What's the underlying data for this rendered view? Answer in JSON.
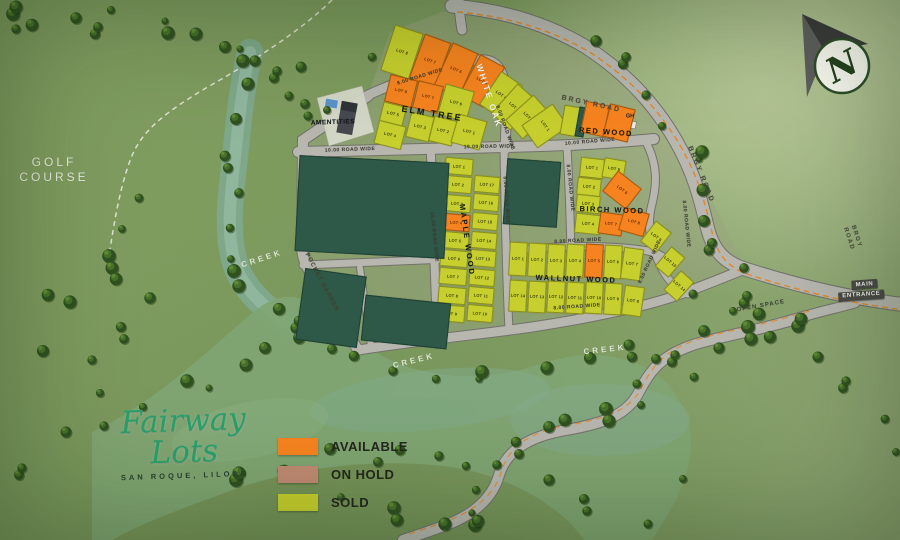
{
  "meta": {
    "title": "Fairway Lots - San Roque, Liloan - Site Development Map"
  },
  "logo": {
    "name": "Fairway Lots",
    "subtitle": "SAN ROQUE, LILOAN",
    "color": "#2aa06b"
  },
  "legend": {
    "items": [
      {
        "label": "AVAILABLE",
        "status": "available",
        "color": "#f6831f"
      },
      {
        "label": "ON HOLD",
        "status": "on_hold",
        "color": "#c08a72"
      },
      {
        "label": "SOLD",
        "status": "sold",
        "color": "#c6cf2d"
      }
    ]
  },
  "compass": {
    "letter": "N"
  },
  "entrance": {
    "line1": "MAIN",
    "line2": "ENTRANCE"
  },
  "blocks": [
    "WHITE OAK",
    "ELM TREE",
    "RED WOOD",
    "BIRCH WOOD",
    "MAPLE WOOD",
    "WALLNUT WOOD"
  ],
  "map": {
    "status_colors": {
      "available": "#f6831f",
      "on_hold": "#c08a72",
      "sold": "#c6cf2d",
      "open": "#2e5847"
    },
    "road_color": "#b7b7b0",
    "labels": [
      {
        "id": "golf-course-label",
        "text": "GOLF\nCOURSE",
        "x": 54,
        "y": 170,
        "rot": 0,
        "size": 12,
        "color": "#e9ece0",
        "ls": 3,
        "weight": 500
      },
      {
        "id": "creek-label-1",
        "text": "CREEK",
        "x": 262,
        "y": 259,
        "rot": -18,
        "size": 8,
        "color": "#dde4d2",
        "ls": 3,
        "weight": 600
      },
      {
        "id": "creek-label-2",
        "text": "CREEK",
        "x": 414,
        "y": 361,
        "rot": -14,
        "size": 8,
        "color": "#dde4d2",
        "ls": 3,
        "weight": 600
      },
      {
        "id": "creek-label-3",
        "text": "CREEK",
        "x": 605,
        "y": 350,
        "rot": -6,
        "size": 8,
        "color": "#dde4d2",
        "ls": 3,
        "weight": 600
      },
      {
        "id": "pocket-garden-label",
        "text": "POCKET GARDEN",
        "x": 321,
        "y": 283,
        "rot": 62,
        "size": 6,
        "color": "#40442f",
        "ls": 1,
        "weight": 600
      },
      {
        "id": "open-space-label",
        "text": "OPEN SPACE",
        "x": 761,
        "y": 307,
        "rot": -10,
        "size": 6,
        "color": "#3f4433",
        "ls": 1,
        "weight": 600
      },
      {
        "id": "brgy-road-label-1",
        "text": "BRGY ROAD",
        "x": 591,
        "y": 105,
        "rot": 12,
        "size": 7,
        "color": "#4a4a42",
        "ls": 2,
        "weight": 700
      },
      {
        "id": "brgy-road-label-2",
        "text": "BRGY ROAD",
        "x": 700,
        "y": 175,
        "rot": 68,
        "size": 7,
        "color": "#4a4a42",
        "ls": 2,
        "weight": 700
      },
      {
        "id": "brgy-road-label-3",
        "text": "BRGY ROAD",
        "x": 852,
        "y": 238,
        "rot": 72,
        "size": 6,
        "color": "#4a4a42",
        "ls": 1.5,
        "weight": 700
      },
      {
        "id": "road-width-label-1",
        "text": "8.00 ROAD WIDE",
        "x": 420,
        "y": 77,
        "rot": -17,
        "size": 5,
        "color": "#3c3c34",
        "ls": 0.5,
        "weight": 600
      },
      {
        "id": "road-width-label-2",
        "text": "8.00 ROAD WIDE",
        "x": 505,
        "y": 128,
        "rot": 70,
        "size": 5,
        "color": "#3c3c34",
        "ls": 0.5,
        "weight": 600
      },
      {
        "id": "road-width-label-3",
        "text": "10.00 ROAD WIDE",
        "x": 350,
        "y": 150,
        "rot": -2,
        "size": 5,
        "color": "#3c3c34",
        "ls": 0.5,
        "weight": 600
      },
      {
        "id": "road-width-label-4",
        "text": "19.00 ROAD WIDE",
        "x": 489,
        "y": 147,
        "rot": -1,
        "size": 5,
        "color": "#3c3c34",
        "ls": 0.5,
        "weight": 600
      },
      {
        "id": "road-width-label-5",
        "text": "10.00 ROAD WIDE",
        "x": 590,
        "y": 142,
        "rot": -5,
        "size": 5,
        "color": "#3c3c34",
        "ls": 0.5,
        "weight": 600
      },
      {
        "id": "road-width-label-6",
        "text": "16.00 ROAD WIDE",
        "x": 434,
        "y": 237,
        "rot": 84,
        "size": 5,
        "color": "#3c3c34",
        "ls": 0.5,
        "weight": 600
      },
      {
        "id": "road-width-label-7",
        "text": "8.00 ROAD WIDE",
        "x": 506,
        "y": 200,
        "rot": 86,
        "size": 5,
        "color": "#3c3c34",
        "ls": 0.5,
        "weight": 600
      },
      {
        "id": "road-width-label-8",
        "text": "8.00 ROAD WIDE",
        "x": 570,
        "y": 188,
        "rot": 84,
        "size": 5,
        "color": "#3c3c34",
        "ls": 0.5,
        "weight": 600
      },
      {
        "id": "road-width-label-9",
        "text": "8.00 ROAD WIDE",
        "x": 578,
        "y": 241,
        "rot": -3,
        "size": 5,
        "color": "#3c3c34",
        "ls": 0.5,
        "weight": 600
      },
      {
        "id": "road-width-label-10",
        "text": "8.00 ROAD WIDE",
        "x": 577,
        "y": 307,
        "rot": -4,
        "size": 5,
        "color": "#3c3c34",
        "ls": 0.5,
        "weight": 600
      },
      {
        "id": "road-width-label-11",
        "text": "8.00 ROAD WIDE",
        "x": 650,
        "y": 262,
        "rot": -65,
        "size": 5,
        "color": "#3c3c34",
        "ls": 0.5,
        "weight": 600
      },
      {
        "id": "road-width-label-12",
        "text": "8.00 ROAD WIDE",
        "x": 686,
        "y": 224,
        "rot": 84,
        "size": 5,
        "color": "#3c3c34",
        "ls": 0.5,
        "weight": 600
      },
      {
        "id": "block-label-white-oak",
        "text": "WHITE OAK",
        "x": 489,
        "y": 96,
        "rot": 72,
        "size": 8.5,
        "color": "#f4f4ec",
        "ls": 2,
        "weight": 700
      },
      {
        "id": "block-label-elm-tree",
        "text": "ELM TREE",
        "x": 432,
        "y": 114,
        "rot": 9,
        "size": 9,
        "color": "#15180f",
        "ls": 2,
        "weight": 700
      },
      {
        "id": "block-label-red-wood",
        "text": "RED WOOD",
        "x": 606,
        "y": 132,
        "rot": 4,
        "size": 7.5,
        "color": "#15180f",
        "ls": 1.5,
        "weight": 700
      },
      {
        "id": "block-label-birch-wood",
        "text": "BIRCH WOOD",
        "x": 612,
        "y": 210,
        "rot": 2,
        "size": 7.5,
        "color": "#15180f",
        "ls": 1.5,
        "weight": 700
      },
      {
        "id": "block-label-maple-wood",
        "text": "MAPLE WOOD",
        "x": 467,
        "y": 240,
        "rot": 82,
        "size": 7.5,
        "color": "#15180f",
        "ls": 2,
        "weight": 700
      },
      {
        "id": "block-label-wallnut-wood",
        "text": "WALLNUT WOOD",
        "x": 576,
        "y": 279,
        "rot": 2,
        "size": 7.5,
        "color": "#15180f",
        "ls": 1.5,
        "weight": 700
      },
      {
        "id": "amenities-label",
        "text": "AMENTITIES",
        "x": 333,
        "y": 123,
        "rot": -2,
        "size": 6.5,
        "color": "#101418",
        "ls": 0.5,
        "weight": 700
      },
      {
        "id": "guard-house-label",
        "text": "GH",
        "x": 630,
        "y": 117,
        "rot": 0,
        "size": 5.5,
        "color": "#22261c",
        "ls": 0,
        "weight": 700
      }
    ],
    "lots": [
      {
        "block": "WHITE OAK",
        "label": "LOT 8",
        "status": "sold",
        "x": 402,
        "y": 52,
        "w": 30,
        "h": 48,
        "r": 18
      },
      {
        "block": "WHITE OAK",
        "label": "LOT 7",
        "status": "available",
        "x": 430,
        "y": 61,
        "w": 28,
        "h": 48,
        "r": 20
      },
      {
        "block": "WHITE OAK",
        "label": "LOT 6",
        "status": "available",
        "x": 456,
        "y": 70,
        "w": 28,
        "h": 48,
        "r": 24
      },
      {
        "block": "WHITE OAK",
        "label": "LOT 5",
        "status": "available",
        "x": 482,
        "y": 81,
        "w": 28,
        "h": 46,
        "r": 28
      },
      {
        "block": "WHITE OAK",
        "label": "LOT 4",
        "status": "sold",
        "x": 501,
        "y": 95,
        "w": 26,
        "h": 40,
        "r": 34
      },
      {
        "block": "WHITE OAK",
        "label": "LOT 3",
        "status": "sold",
        "x": 514,
        "y": 107,
        "w": 26,
        "h": 40,
        "r": 42
      },
      {
        "block": "WHITE OAK",
        "label": "LOT 2",
        "status": "sold",
        "x": 528,
        "y": 117,
        "w": 26,
        "h": 38,
        "r": 48
      },
      {
        "block": "WHITE OAK",
        "label": "LOT 1",
        "status": "sold",
        "x": 545,
        "y": 126,
        "w": 28,
        "h": 38,
        "r": 55
      },
      {
        "block": "ELM TREE",
        "label": "LOT 8",
        "status": "available",
        "x": 401,
        "y": 91,
        "w": 28,
        "h": 28,
        "r": 14
      },
      {
        "block": "ELM TREE",
        "label": "LOT 7",
        "status": "available",
        "x": 428,
        "y": 97,
        "w": 26,
        "h": 28,
        "r": 14
      },
      {
        "block": "ELM TREE",
        "label": "LOT 6",
        "status": "sold",
        "x": 456,
        "y": 103,
        "w": 30,
        "h": 32,
        "r": 16
      },
      {
        "block": "ELM TREE",
        "label": "LOT 5",
        "status": "sold",
        "x": 393,
        "y": 114,
        "w": 24,
        "h": 20,
        "r": 14
      },
      {
        "block": "ELM TREE",
        "label": "LOT 4",
        "status": "sold",
        "x": 390,
        "y": 135,
        "w": 28,
        "h": 24,
        "r": 14
      },
      {
        "block": "ELM TREE",
        "label": "LOT 3",
        "status": "sold",
        "x": 420,
        "y": 127,
        "w": 24,
        "h": 26,
        "r": 14
      },
      {
        "block": "ELM TREE",
        "label": "LOT 2",
        "status": "sold",
        "x": 443,
        "y": 131,
        "w": 24,
        "h": 26,
        "r": 14
      },
      {
        "block": "ELM TREE",
        "label": "LOT 1",
        "status": "sold",
        "x": 469,
        "y": 132,
        "w": 30,
        "h": 30,
        "r": 16
      },
      {
        "block": "RED WOOD",
        "label": "",
        "status": "sold",
        "x": 571,
        "y": 121,
        "w": 18,
        "h": 30,
        "r": 10
      },
      {
        "block": "RED WOOD",
        "label": "",
        "status": "open",
        "x": 581,
        "y": 122,
        "w": 9,
        "h": 30,
        "r": 10
      },
      {
        "block": "RED WOOD",
        "label": "",
        "status": "available",
        "x": 595,
        "y": 119,
        "w": 24,
        "h": 32,
        "r": 12
      },
      {
        "block": "RED WOOD",
        "label": "",
        "status": "available",
        "x": 619,
        "y": 123,
        "w": 26,
        "h": 34,
        "r": 14
      },
      {
        "block": "BIRCH WOOD",
        "label": "LOT 1",
        "status": "sold",
        "x": 592,
        "y": 168,
        "w": 24,
        "h": 20,
        "r": 6
      },
      {
        "block": "BIRCH WOOD",
        "label": "LOT 5",
        "status": "sold",
        "x": 614,
        "y": 169,
        "w": 22,
        "h": 20,
        "r": 10
      },
      {
        "block": "BIRCH WOOD",
        "label": "LOT 2",
        "status": "sold",
        "x": 589,
        "y": 187,
        "w": 24,
        "h": 18,
        "r": 6
      },
      {
        "block": "BIRCH WOOD",
        "label": "LOT 6",
        "status": "available",
        "x": 622,
        "y": 190,
        "w": 30,
        "h": 26,
        "r": 38
      },
      {
        "block": "BIRCH WOOD",
        "label": "LOT 3",
        "status": "sold",
        "x": 588,
        "y": 204,
        "w": 24,
        "h": 18,
        "r": 6
      },
      {
        "block": "BIRCH WOOD",
        "label": "LOT 4",
        "status": "sold",
        "x": 588,
        "y": 224,
        "w": 26,
        "h": 20,
        "r": 6
      },
      {
        "block": "BIRCH WOOD",
        "label": "LOT 7",
        "status": "available",
        "x": 611,
        "y": 224,
        "w": 24,
        "h": 22,
        "r": 8
      },
      {
        "block": "BIRCH WOOD",
        "label": "LOT 8",
        "status": "available",
        "x": 634,
        "y": 222,
        "w": 26,
        "h": 24,
        "r": 16
      },
      {
        "block": "BIRCH WOOD",
        "label": "LOT 9",
        "status": "sold",
        "x": 656,
        "y": 237,
        "w": 20,
        "h": 26,
        "r": 38
      },
      {
        "block": "BIRCH WOOD",
        "label": "LOT 15",
        "status": "sold",
        "x": 670,
        "y": 262,
        "w": 18,
        "h": 26,
        "r": 40
      },
      {
        "block": "BIRCH WOOD",
        "label": "LOT 14",
        "status": "sold",
        "x": 679,
        "y": 286,
        "w": 18,
        "h": 26,
        "r": 42
      },
      {
        "block": "MAPLE WOOD",
        "label": "LOT 1",
        "status": "sold",
        "x": 459,
        "y": 166,
        "w": 28,
        "h": 17,
        "r": 5
      },
      {
        "block": "MAPLE WOOD",
        "label": "LOT 2",
        "status": "sold",
        "x": 458,
        "y": 184,
        "w": 28,
        "h": 17,
        "r": 5
      },
      {
        "block": "MAPLE WOOD",
        "label": "LOT 3",
        "status": "sold",
        "x": 457,
        "y": 203,
        "w": 28,
        "h": 17,
        "r": 5
      },
      {
        "block": "MAPLE WOOD",
        "label": "LOT 4",
        "status": "available",
        "x": 456,
        "y": 222,
        "w": 28,
        "h": 17,
        "r": 5
      },
      {
        "block": "MAPLE WOOD",
        "label": "LOT 5",
        "status": "sold",
        "x": 455,
        "y": 240,
        "w": 28,
        "h": 17,
        "r": 5
      },
      {
        "block": "MAPLE WOOD",
        "label": "LOT 6",
        "status": "sold",
        "x": 454,
        "y": 258,
        "w": 28,
        "h": 17,
        "r": 5
      },
      {
        "block": "MAPLE WOOD",
        "label": "LOT 7",
        "status": "sold",
        "x": 453,
        "y": 276,
        "w": 28,
        "h": 17,
        "r": 5
      },
      {
        "block": "MAPLE WOOD",
        "label": "LOT 8",
        "status": "sold",
        "x": 452,
        "y": 295,
        "w": 28,
        "h": 17,
        "r": 5
      },
      {
        "block": "MAPLE WOOD",
        "label": "LOT 9",
        "status": "sold",
        "x": 451,
        "y": 313,
        "w": 28,
        "h": 17,
        "r": 5
      },
      {
        "block": "MAPLE WOOD",
        "label": "LOT 17",
        "status": "sold",
        "x": 487,
        "y": 184,
        "w": 26,
        "h": 17,
        "r": 5
      },
      {
        "block": "MAPLE WOOD",
        "label": "LOT 16",
        "status": "sold",
        "x": 486,
        "y": 202,
        "w": 26,
        "h": 17,
        "r": 5
      },
      {
        "block": "MAPLE WOOD",
        "label": "LOT 15",
        "status": "sold",
        "x": 485,
        "y": 221,
        "w": 26,
        "h": 17,
        "r": 5
      },
      {
        "block": "MAPLE WOOD",
        "label": "LOT 14",
        "status": "sold",
        "x": 484,
        "y": 240,
        "w": 26,
        "h": 17,
        "r": 5
      },
      {
        "block": "MAPLE WOOD",
        "label": "LOT 13",
        "status": "sold",
        "x": 483,
        "y": 258,
        "w": 26,
        "h": 17,
        "r": 5
      },
      {
        "block": "MAPLE WOOD",
        "label": "LOT 12",
        "status": "sold",
        "x": 482,
        "y": 277,
        "w": 26,
        "h": 17,
        "r": 5
      },
      {
        "block": "MAPLE WOOD",
        "label": "LOT 11",
        "status": "sold",
        "x": 481,
        "y": 295,
        "w": 26,
        "h": 17,
        "r": 5
      },
      {
        "block": "MAPLE WOOD",
        "label": "LOT 10",
        "status": "sold",
        "x": 480,
        "y": 313,
        "w": 26,
        "h": 17,
        "r": 5
      },
      {
        "block": "WALLNUT WOOD",
        "label": "LOT 1",
        "status": "sold",
        "x": 518,
        "y": 259,
        "w": 18,
        "h": 34,
        "r": 3
      },
      {
        "block": "WALLNUT WOOD",
        "label": "LOT 2",
        "status": "sold",
        "x": 537,
        "y": 260,
        "w": 18,
        "h": 34,
        "r": 3
      },
      {
        "block": "WALLNUT WOOD",
        "label": "LOT 3",
        "status": "sold",
        "x": 556,
        "y": 261,
        "w": 18,
        "h": 34,
        "r": 3
      },
      {
        "block": "WALLNUT WOOD",
        "label": "LOT 4",
        "status": "sold",
        "x": 575,
        "y": 261,
        "w": 18,
        "h": 34,
        "r": 3
      },
      {
        "block": "WALLNUT WOOD",
        "label": "LOT 5",
        "status": "available",
        "x": 594,
        "y": 261,
        "w": 18,
        "h": 34,
        "r": 3
      },
      {
        "block": "WALLNUT WOOD",
        "label": "LOT 6",
        "status": "sold",
        "x": 613,
        "y": 262,
        "w": 18,
        "h": 34,
        "r": 3
      },
      {
        "block": "WALLNUT WOOD",
        "label": "LOT 7",
        "status": "sold",
        "x": 632,
        "y": 264,
        "w": 20,
        "h": 32,
        "r": 8
      },
      {
        "block": "WALLNUT WOOD",
        "label": "LOT 14",
        "status": "sold",
        "x": 518,
        "y": 296,
        "w": 18,
        "h": 32,
        "r": 3
      },
      {
        "block": "WALLNUT WOOD",
        "label": "LOT 13",
        "status": "sold",
        "x": 537,
        "y": 297,
        "w": 18,
        "h": 32,
        "r": 3
      },
      {
        "block": "WALLNUT WOOD",
        "label": "LOT 12",
        "status": "sold",
        "x": 556,
        "y": 297,
        "w": 18,
        "h": 32,
        "r": 3
      },
      {
        "block": "WALLNUT WOOD",
        "label": "LOT 11",
        "status": "sold",
        "x": 575,
        "y": 298,
        "w": 18,
        "h": 32,
        "r": 3
      },
      {
        "block": "WALLNUT WOOD",
        "label": "LOT 10",
        "status": "sold",
        "x": 594,
        "y": 298,
        "w": 18,
        "h": 32,
        "r": 3
      },
      {
        "block": "WALLNUT WOOD",
        "label": "LOT 9",
        "status": "sold",
        "x": 613,
        "y": 299,
        "w": 18,
        "h": 32,
        "r": 3
      },
      {
        "block": "WALLNUT WOOD",
        "label": "LOT 8",
        "status": "sold",
        "x": 633,
        "y": 301,
        "w": 20,
        "h": 30,
        "r": 8
      },
      {
        "block": "",
        "label": "",
        "status": "open",
        "x": 372,
        "y": 207,
        "w": 150,
        "h": 96,
        "r": 3
      },
      {
        "block": "",
        "label": "",
        "status": "open",
        "x": 331,
        "y": 308,
        "w": 62,
        "h": 72,
        "r": 8
      },
      {
        "block": "",
        "label": "",
        "status": "open",
        "x": 406,
        "y": 322,
        "w": 86,
        "h": 46,
        "r": 6
      },
      {
        "block": "",
        "label": "",
        "status": "open",
        "x": 532,
        "y": 193,
        "w": 54,
        "h": 66,
        "r": 4
      }
    ]
  }
}
